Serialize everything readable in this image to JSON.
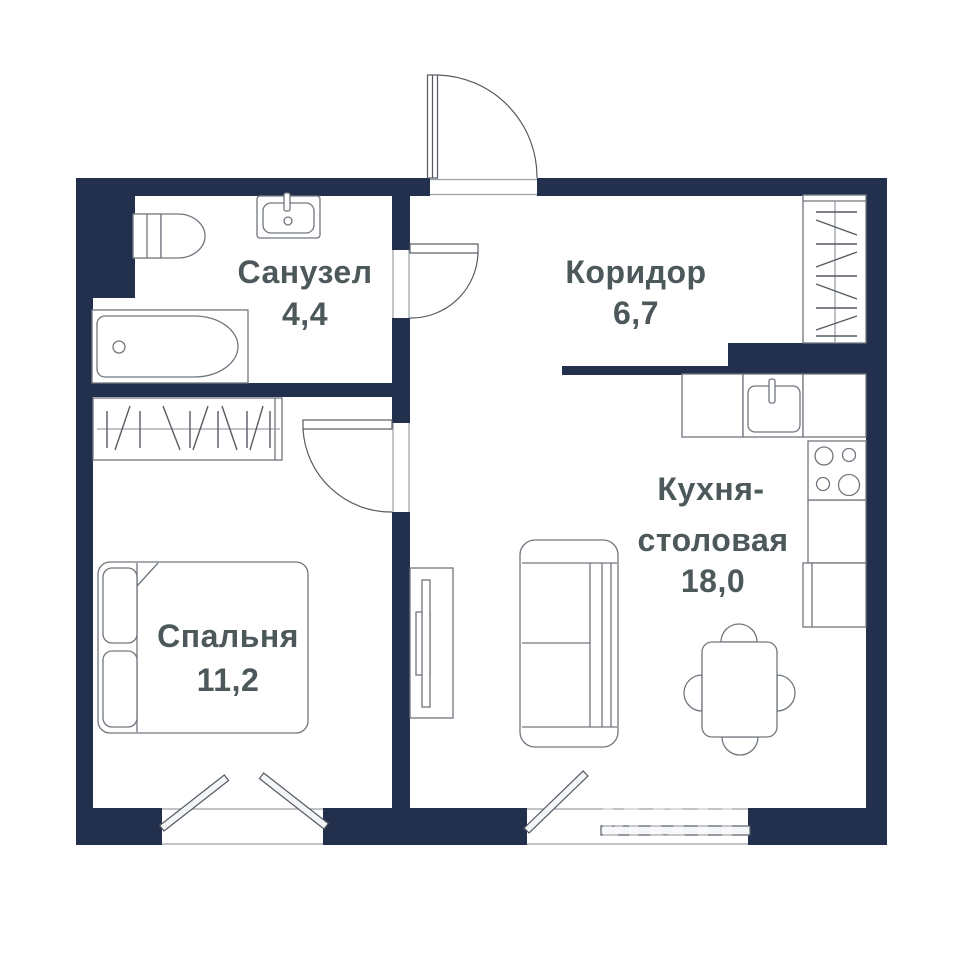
{
  "plan_title": "apartment-floor-plan",
  "rooms": {
    "bathroom": {
      "name": "Санузел",
      "area": "4,4"
    },
    "corridor": {
      "name": "Коридор",
      "area": "6,7"
    },
    "bedroom": {
      "name": "Спальня",
      "area": "11,2"
    },
    "kitchen_dining": {
      "name_line1": "Кухня-",
      "name_line2": "столовая",
      "area": "18,0"
    }
  },
  "watermark": "иан",
  "colors": {
    "wall": "#22304e",
    "label_text": "#4d585a",
    "furniture_outline": "#70767e",
    "background": "#ffffff"
  }
}
